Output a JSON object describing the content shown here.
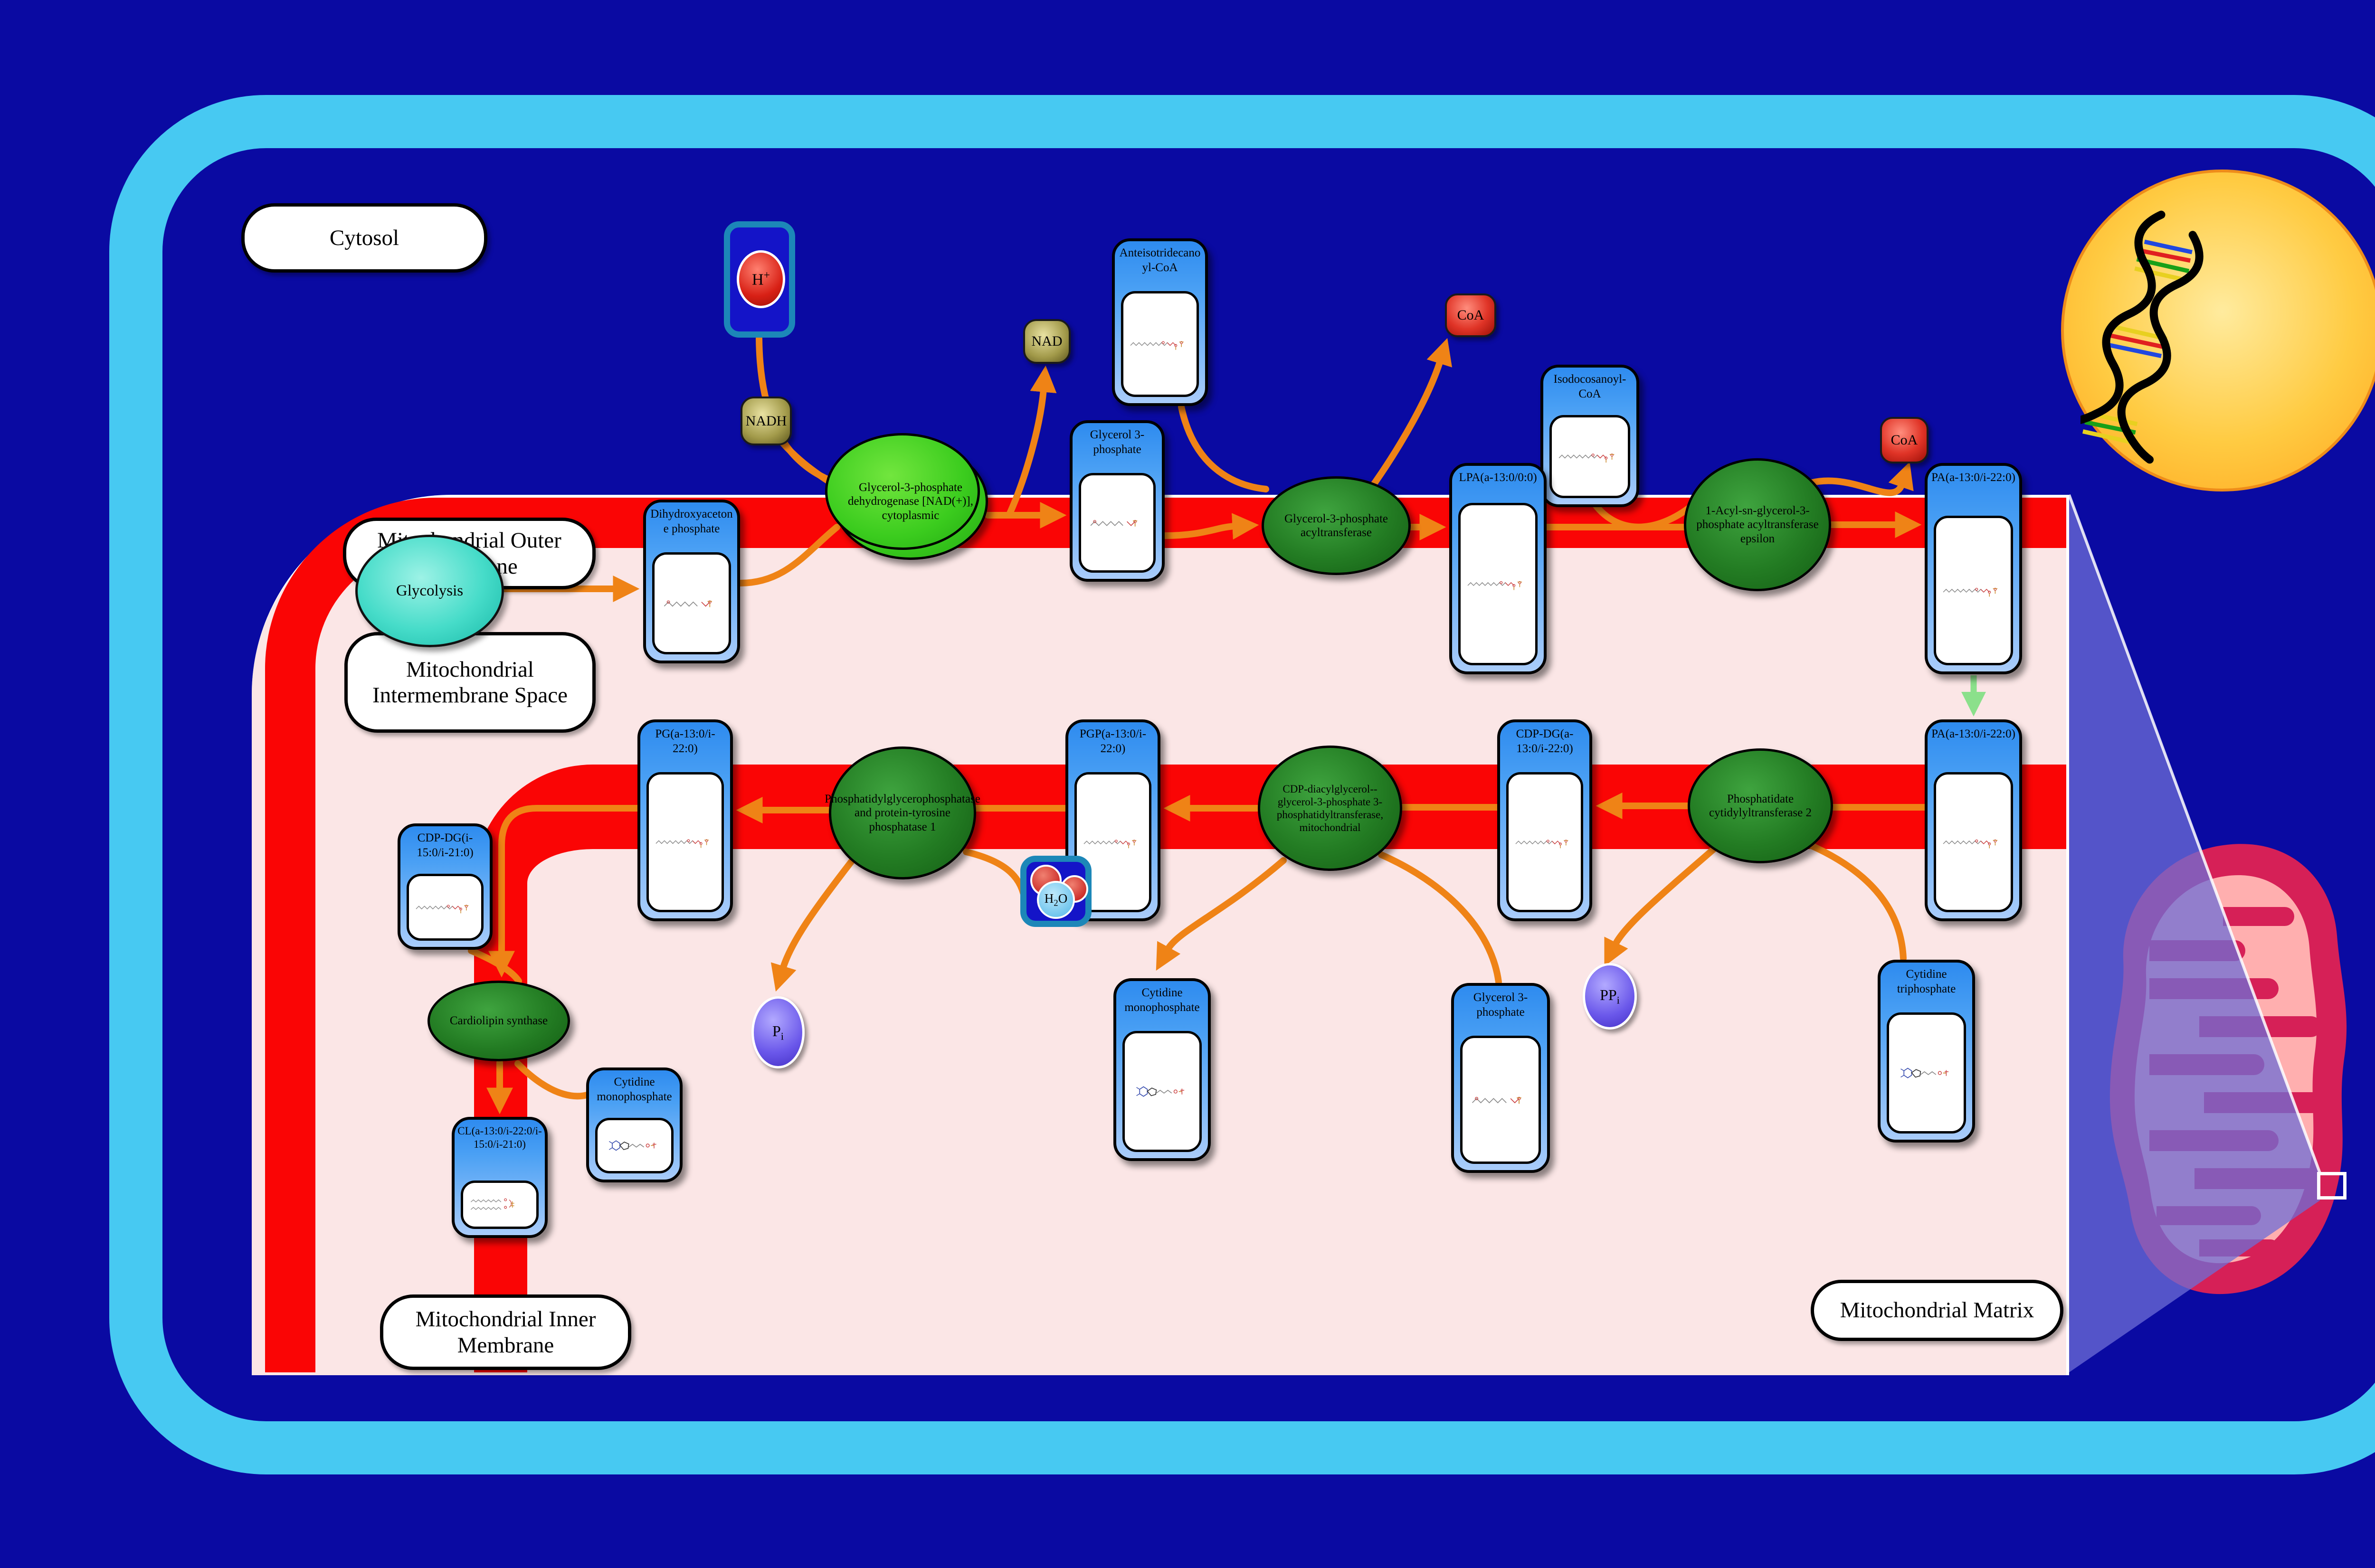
{
  "regions": {
    "cytosol": "Cytosol",
    "outer_membrane": "Mitochondrial Outer Membrane",
    "intermembrane_space": "Mitochondrial Intermembrane Space",
    "inner_membrane": "Mitochondrial Inner Membrane",
    "matrix": "Mitochondrial Matrix"
  },
  "process": {
    "glycolysis": "Glycolysis"
  },
  "enzymes": {
    "gpd1": "Glycerol-3-phosphate dehydrogenase [NAD(+)], cytoplasmic",
    "gpat": "Glycerol-3-phosphate acyltransferase",
    "agpat": "1-Acyl-sn-glycerol-3-phosphate acyltransferase epsilon",
    "cds2": "Phosphatidate cytidylyltransferase 2",
    "pgs1": "CDP-diacylglycerol--glycerol-3-phosphate 3-phosphatidyltransferase, mitochondrial",
    "ptpmt1": "Phosphatidylglycerophosphatase and protein-tyrosine phosphatase 1",
    "crls1": "Cardiolipin synthase"
  },
  "metabolites": {
    "dhap": "Dihydroxyacetone phosphate",
    "g3p_top": "Glycerol 3-phosphate",
    "anteiso_coa": "Anteisotridecanoyl-CoA",
    "isodoco_coa": "Isodocosanoyl-CoA",
    "lpa": "LPA(a-13:0/0:0)",
    "pa_outer": "PA(a-13:0/i-22:0)",
    "pa_inner": "PA(a-13:0/i-22:0)",
    "cdp_dg": "CDP-DG(a-13:0/i-22:0)",
    "pgp": "PGP(a-13:0/i-22:0)",
    "pg": "PG(a-13:0/i-22:0)",
    "cdp_dg2": "CDP-DG(i-15:0/i-21:0)",
    "cl": "CL(a-13:0/i-22:0/i-15:0/i-21:0)",
    "cmp_upper": "Cytidine monophosphate",
    "cmp_lower": "Cytidine monophosphate",
    "g3p_lower": "Glycerol 3-phosphate",
    "ctp": "Cytidine triphosphate"
  },
  "cofactors": {
    "nadh": "NADH",
    "nad": "NAD",
    "coa1": "CoA",
    "coa2": "CoA",
    "h_plus": {
      "base": "H",
      "sup": "+"
    },
    "h2o": {
      "pre": "H",
      "sub": "2",
      "post": "O"
    },
    "pi": {
      "base": "P",
      "sub": "i"
    },
    "ppi": {
      "base": "PP",
      "sub": "i"
    }
  },
  "colors": {
    "background_navy": "#0a0aa2",
    "cell_membrane_cyan": "#47c9f2",
    "membrane_red": "#fa0505",
    "matrix_pink": "#fbe6e6",
    "metabolite_blue": "#2e8bef",
    "enzyme_green_dark": "#237c23",
    "enzyme_green_bright": "#3bcc1e",
    "arrow_orange": "#ef8316",
    "transport_arrow_green": "#8be08b",
    "cofactor_khaki": "#a29a4a",
    "coa_red": "#e03427",
    "phosphate_purple": "#6a57ea",
    "nucleus_yellow": "#ffcb42",
    "mitochondrion_crimson": "#d62057",
    "mitochondrion_pink": "#ffafaf"
  }
}
